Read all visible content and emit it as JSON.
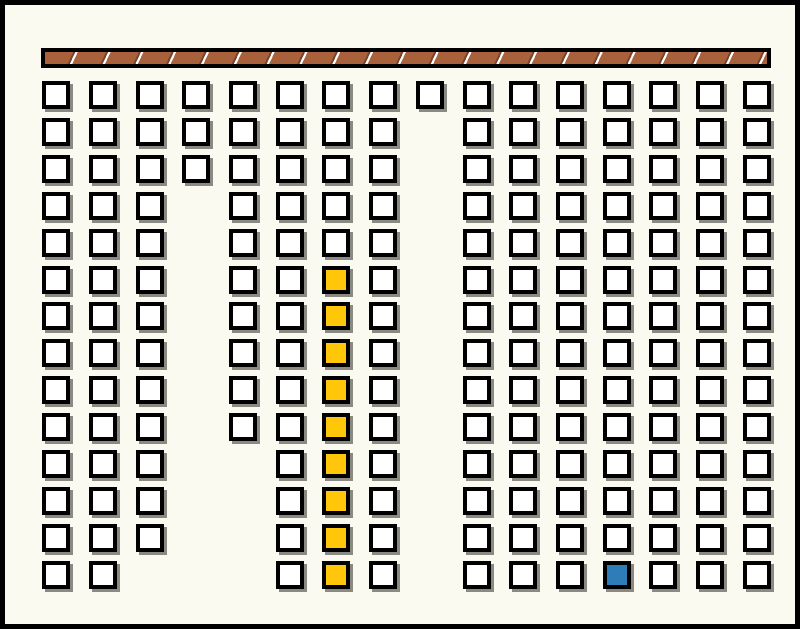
{
  "canvas": {
    "width": 800,
    "height": 629,
    "background": "#FBFAF0",
    "border_color": "#000000",
    "border_width": 5
  },
  "conveyor_bar": {
    "x": 36,
    "y": 43,
    "width": 730,
    "height": 20,
    "edge_color": "#000000",
    "edge_width": 4,
    "fill_color": "#A8613B",
    "dark_edge_color": "#79432B",
    "divider_color": "#FFFFFF",
    "segment_count": 22,
    "divider_angle_deg": 115
  },
  "grid": {
    "square_size": 28,
    "square_border": 4,
    "square_fill": "#FFFFFF",
    "outline_color": "#000000",
    "shadow_color": "#8B8A82",
    "shadow_offset": 3,
    "highlight_color": "#FFC60A",
    "target_color": "#2E7CB8",
    "rows_y": [
      76,
      113,
      150,
      187,
      224,
      261,
      297,
      334,
      371,
      408,
      445,
      482,
      519,
      556
    ],
    "columns": [
      {
        "x": 37,
        "row_start": 1,
        "row_end": 14
      },
      {
        "x": 84,
        "row_start": 1,
        "row_end": 14
      },
      {
        "x": 131,
        "row_start": 1,
        "row_end": 13
      },
      {
        "x": 177,
        "row_start": 1,
        "row_end": 3
      },
      {
        "x": 224,
        "row_start": 1,
        "row_end": 10
      },
      {
        "x": 271,
        "row_start": 1,
        "row_end": 14
      },
      {
        "x": 317,
        "row_start": 1,
        "row_end": 14,
        "highlight_rows": [
          6,
          14
        ]
      },
      {
        "x": 364,
        "row_start": 1,
        "row_end": 14
      },
      {
        "x": 411,
        "row_start": 1,
        "row_end": 1
      },
      {
        "x": 458,
        "row_start": 1,
        "row_end": 14
      },
      {
        "x": 504,
        "row_start": 1,
        "row_end": 14
      },
      {
        "x": 551,
        "row_start": 1,
        "row_end": 14
      },
      {
        "x": 598,
        "row_start": 1,
        "row_end": 14,
        "target_rows": [
          14,
          14
        ]
      },
      {
        "x": 644,
        "row_start": 1,
        "row_end": 14
      },
      {
        "x": 691,
        "row_start": 1,
        "row_end": 14
      },
      {
        "x": 738,
        "row_start": 1,
        "row_end": 14
      }
    ]
  }
}
